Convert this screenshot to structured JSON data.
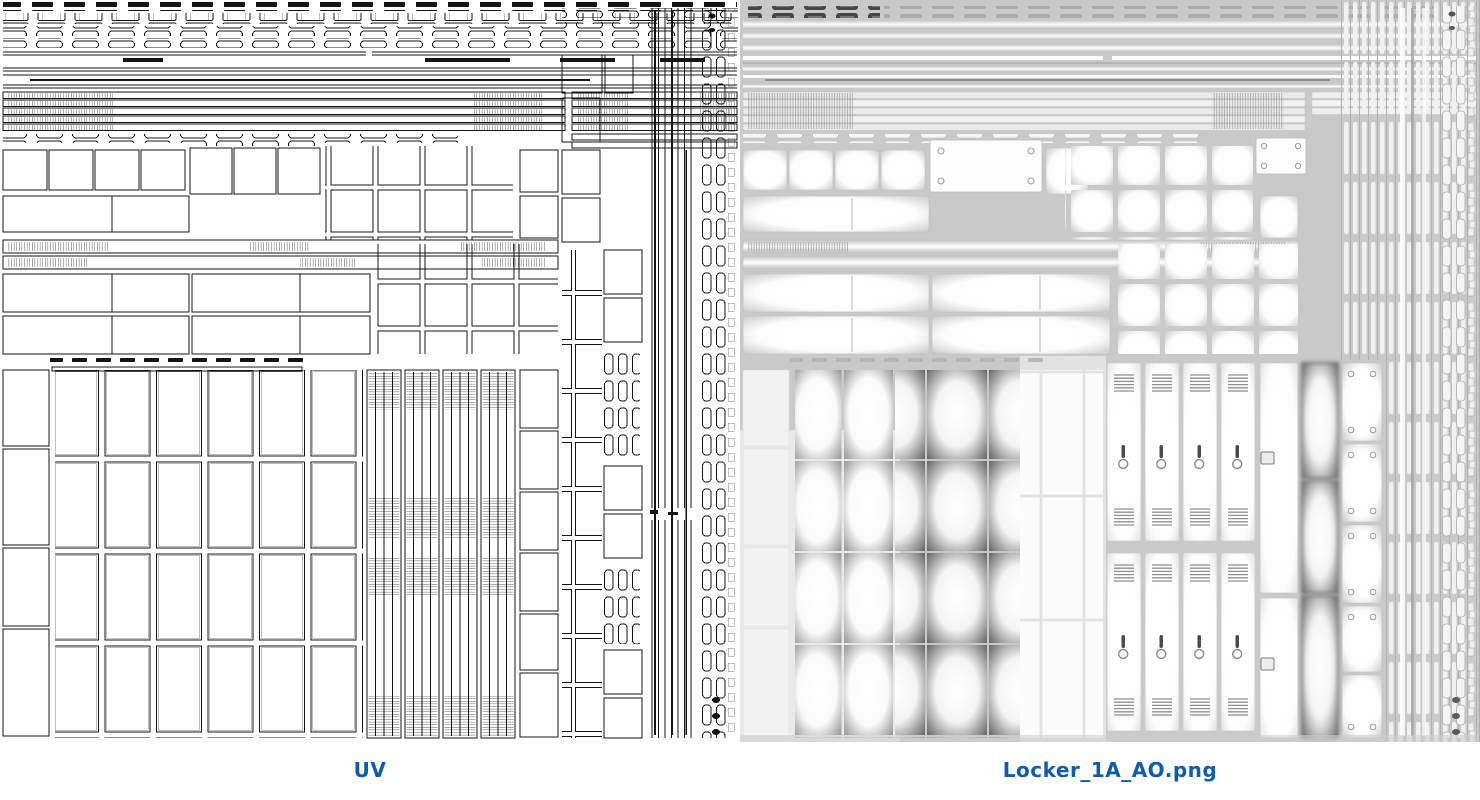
{
  "captions": {
    "uv": "UV",
    "ao": "Locker_1A_AO.png"
  },
  "colors": {
    "caption_blue": "#0d5cb0",
    "uv_ink": "#141414",
    "ao_bg": "#c9c9c9"
  },
  "panels": {
    "left_type": "uv-wireframe-atlas",
    "right_type": "ambient-occlusion-texture"
  }
}
